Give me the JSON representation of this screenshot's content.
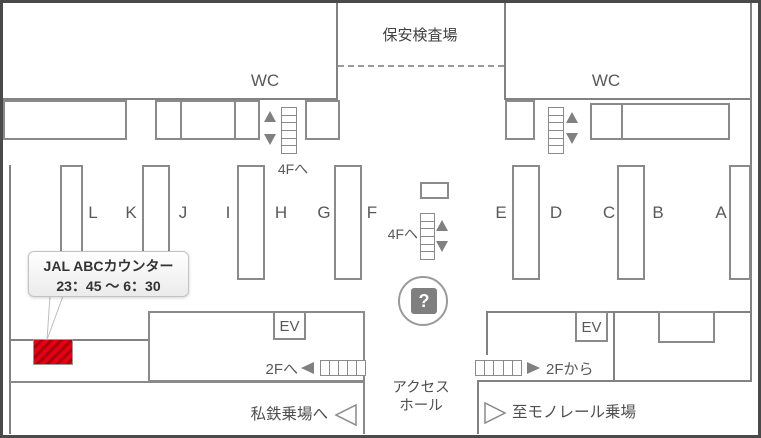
{
  "colors": {
    "jal_red": "#e60012",
    "jal_red_stripe": "#a8000f",
    "wall_gray": "#828282",
    "icon_gray": "#7f7f7f",
    "frame_dark": "#4a4a4a"
  },
  "map": {
    "labels": {
      "security_area": "保安検査場",
      "wc_left": "WC",
      "wc_right": "WC",
      "to_4f_left": "4Fへ",
      "to_4f_center": "4Fへ",
      "elevator_left": "EV",
      "elevator_right": "EV",
      "to_2f": "2Fへ",
      "from_2f": "2Fから",
      "access_hall_line1": "アクセス",
      "access_hall_line2": "ホール",
      "private_railway": "私鉄乗場へ",
      "monorail": "至モノレール乗場",
      "info": "?"
    },
    "counter_labels": [
      "L",
      "K",
      "J",
      "I",
      "H",
      "G",
      "F",
      "E",
      "D",
      "C",
      "B",
      "A"
    ],
    "tooltip": {
      "title": "JAL ABCカウンター",
      "hours": "23：45 ～ 6：30"
    }
  }
}
